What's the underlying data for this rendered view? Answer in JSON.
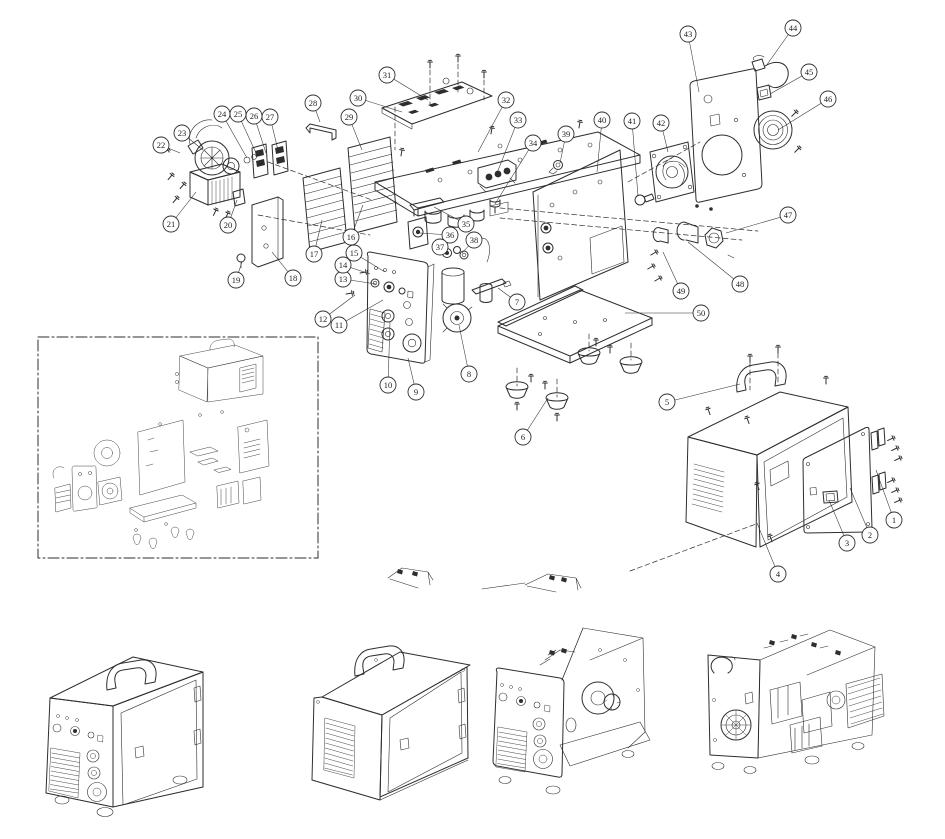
{
  "colors": {
    "line": "#2e2e2e",
    "background": "#ffffff",
    "callout_fill": "#ffffff"
  },
  "diagram": {
    "callouts": [
      {
        "n": "1",
        "x": 894,
        "y": 520,
        "tx": 876,
        "ty": 470
      },
      {
        "n": "2",
        "x": 870,
        "y": 535,
        "tx": 850,
        "ty": 488
      },
      {
        "n": "3",
        "x": 847,
        "y": 543,
        "tx": 829,
        "ty": 500
      },
      {
        "n": "4",
        "x": 778,
        "y": 574,
        "tx": 757,
        "ty": 523
      },
      {
        "n": "5",
        "x": 667,
        "y": 402,
        "tx": 740,
        "ty": 384
      },
      {
        "n": "6",
        "x": 523,
        "y": 437,
        "tx": 548,
        "ty": 398
      },
      {
        "n": "7",
        "x": 517,
        "y": 302,
        "tx": 498,
        "ty": 288
      },
      {
        "n": "8",
        "x": 469,
        "y": 374,
        "tx": 459,
        "ty": 325
      },
      {
        "n": "9",
        "x": 416,
        "y": 392,
        "tx": 408,
        "ty": 358
      },
      {
        "n": "10",
        "x": 388,
        "y": 385,
        "tx": 390,
        "ty": 322
      },
      {
        "n": "11",
        "x": 339,
        "y": 325,
        "tx": 383,
        "ty": 300
      },
      {
        "n": "12",
        "x": 323,
        "y": 319,
        "tx": 355,
        "ty": 295
      },
      {
        "n": "13",
        "x": 343,
        "y": 279,
        "tx": 376,
        "ty": 284
      },
      {
        "n": "14",
        "x": 343,
        "y": 265,
        "tx": 370,
        "ty": 274
      },
      {
        "n": "15",
        "x": 354,
        "y": 253,
        "tx": 385,
        "ty": 272
      },
      {
        "n": "16",
        "x": 351,
        "y": 237,
        "tx": 363,
        "ty": 205
      },
      {
        "n": "17",
        "x": 314,
        "y": 254,
        "tx": 322,
        "ty": 220
      },
      {
        "n": "18",
        "x": 293,
        "y": 278,
        "tx": 272,
        "ty": 252
      },
      {
        "n": "19",
        "x": 236,
        "y": 280,
        "tx": 242,
        "ty": 262
      },
      {
        "n": "20",
        "x": 228,
        "y": 225,
        "tx": 237,
        "ty": 200
      },
      {
        "n": "21",
        "x": 171,
        "y": 224,
        "tx": 196,
        "ty": 192
      },
      {
        "n": "22",
        "x": 161,
        "y": 145,
        "tx": 180,
        "ty": 153
      },
      {
        "n": "23",
        "x": 182,
        "y": 133,
        "tx": 203,
        "ty": 150
      },
      {
        "n": "24",
        "x": 222,
        "y": 114,
        "tx": 247,
        "ty": 158
      },
      {
        "n": "25",
        "x": 238,
        "y": 114,
        "tx": 257,
        "ty": 155
      },
      {
        "n": "26",
        "x": 254,
        "y": 116,
        "tx": 266,
        "ty": 153
      },
      {
        "n": "27",
        "x": 270,
        "y": 117,
        "tx": 278,
        "ty": 150
      },
      {
        "n": "28",
        "x": 313,
        "y": 103,
        "tx": 320,
        "ty": 122
      },
      {
        "n": "29",
        "x": 349,
        "y": 117,
        "tx": 362,
        "ty": 150
      },
      {
        "n": "30",
        "x": 358,
        "y": 98,
        "tx": 402,
        "ty": 112
      },
      {
        "n": "31",
        "x": 387,
        "y": 75,
        "tx": 428,
        "ty": 100
      },
      {
        "n": "32",
        "x": 506,
        "y": 100,
        "tx": 478,
        "ty": 152
      },
      {
        "n": "33",
        "x": 518,
        "y": 120,
        "tx": 497,
        "ty": 173
      },
      {
        "n": "34",
        "x": 533,
        "y": 143,
        "tx": 495,
        "ty": 204
      },
      {
        "n": "35",
        "x": 466,
        "y": 224,
        "tx": 434,
        "ty": 207
      },
      {
        "n": "36",
        "x": 450,
        "y": 235,
        "tx": 420,
        "ty": 233
      },
      {
        "n": "37",
        "x": 440,
        "y": 247,
        "tx": 447,
        "ty": 253
      },
      {
        "n": "38",
        "x": 474,
        "y": 240,
        "tx": 462,
        "ty": 253
      },
      {
        "n": "39",
        "x": 566,
        "y": 134,
        "tx": 560,
        "ty": 163
      },
      {
        "n": "40",
        "x": 602,
        "y": 120,
        "tx": 597,
        "ty": 172
      },
      {
        "n": "41",
        "x": 632,
        "y": 121,
        "tx": 638,
        "ty": 196
      },
      {
        "n": "42",
        "x": 661,
        "y": 123,
        "tx": 668,
        "ty": 152
      },
      {
        "n": "43",
        "x": 688,
        "y": 34,
        "tx": 699,
        "ty": 92
      },
      {
        "n": "44",
        "x": 793,
        "y": 28,
        "tx": 766,
        "ty": 66
      },
      {
        "n": "45",
        "x": 809,
        "y": 72,
        "tx": 770,
        "ty": 94
      },
      {
        "n": "46",
        "x": 828,
        "y": 99,
        "tx": 778,
        "ty": 130
      },
      {
        "n": "47",
        "x": 788,
        "y": 215,
        "tx": 726,
        "ty": 233
      },
      {
        "n": "48",
        "x": 740,
        "y": 284,
        "tx": 688,
        "ty": 242
      },
      {
        "n": "49",
        "x": 681,
        "y": 291,
        "tx": 663,
        "ty": 252
      },
      {
        "n": "50",
        "x": 701,
        "y": 313,
        "tx": 625,
        "ty": 313
      }
    ]
  }
}
